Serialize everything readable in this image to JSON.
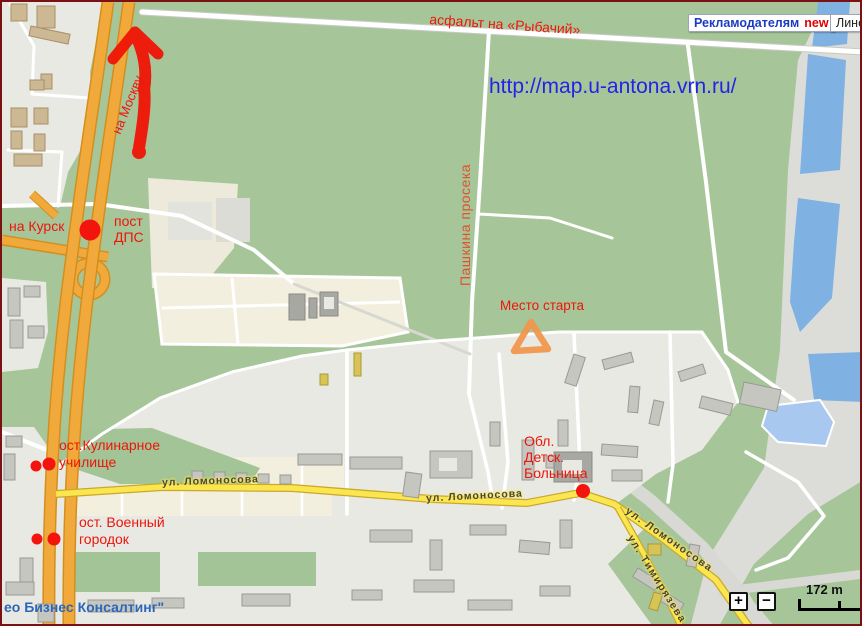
{
  "annotations": {
    "rybachiy": "асфальт на «Рыбачий»",
    "na_moskvu": "на Москву",
    "na_kursk": "на Курск",
    "post_dps": {
      "line1": "пост",
      "line2": "ДПС"
    },
    "pashkina": "Пашкина просека",
    "mesto_starta": "Место старта",
    "kulinarnoe": {
      "line1": "ост.Кулинарное",
      "line2": "училище"
    },
    "voenny": {
      "line1": "ост. Военный",
      "line2": "городок"
    },
    "bolnitsa": {
      "line1": "Обл.",
      "line2": "Детск.",
      "line3": "Больница"
    },
    "url_watermark": "http://map.u-antona.vrn.ru/",
    "logo": "ео Бизнес Консалтинг\""
  },
  "streets": {
    "lomonosova_1": "ул. Ломоносова",
    "lomonosova_2": "ул. Ломоносова",
    "lomonosova_3": "ул. Ломоносова",
    "timiryazeva": "ул. Тимирязева"
  },
  "header": {
    "advertisers_label": "Рекламодателям",
    "advertisers_badge": "new",
    "ruler_label": "Линей"
  },
  "map_controls": {
    "zoom_in": "+",
    "zoom_out": "−",
    "scale_label": "172 m"
  },
  "markers": [
    {
      "name": "route-arrow-marker",
      "shape": "hand-drawn-arrow",
      "color": "#f01505"
    },
    {
      "name": "dps-dot-marker",
      "shape": "dot",
      "color": "#f3140e"
    },
    {
      "name": "kulinarnoe-stop-dots",
      "shape": "dot-pair",
      "color": "#f3140e"
    },
    {
      "name": "voenny-stop-dots",
      "shape": "dot-pair",
      "color": "#f3140e"
    },
    {
      "name": "bolnitsa-dot-marker",
      "shape": "dot",
      "color": "#f3140e"
    },
    {
      "name": "start-triangle-marker",
      "shape": "hand-drawn-triangle",
      "color": "#f0974e"
    }
  ],
  "colors": {
    "annotation_red": "#ee1509",
    "pashkina_label": "#e2512b",
    "marker_red": "#f3140e",
    "start_triangle_orange": "#f0974e",
    "url_blue": "#2323e8",
    "logo_blue": "#2d66b8",
    "advertisers_blue": "#1b3bc4",
    "new_badge_red": "#e00000",
    "forest_green": "#a6c69a",
    "water_blue": "#7fb1e3",
    "highway_orange": "#f2a93b",
    "street_yellow": "#fbe64f"
  }
}
